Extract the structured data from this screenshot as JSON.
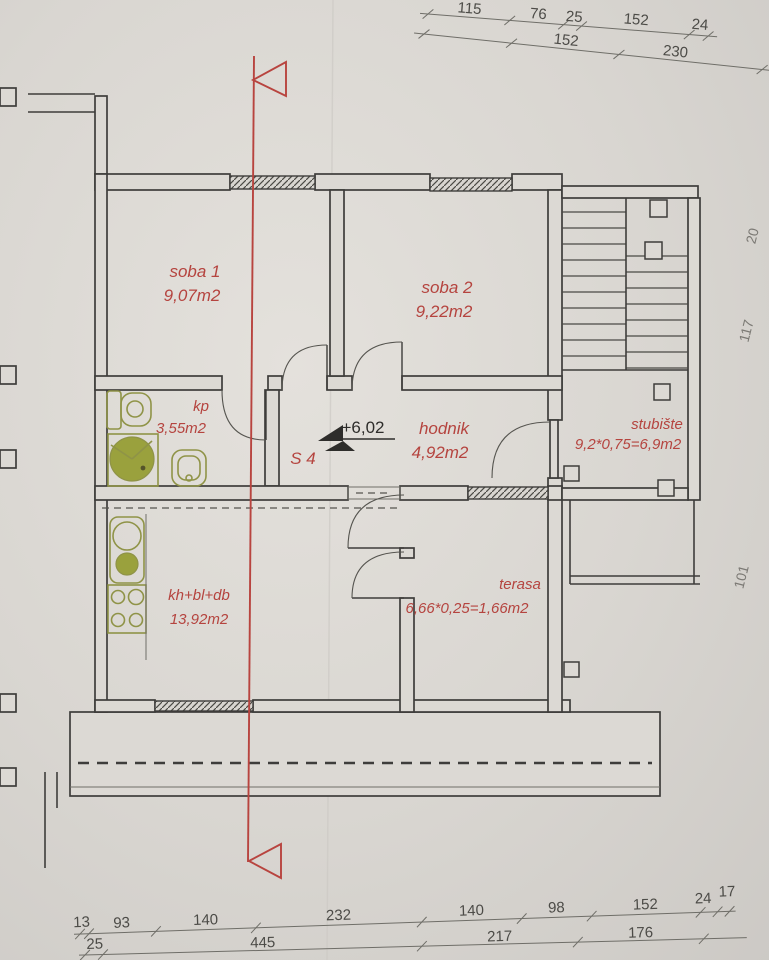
{
  "plan": {
    "rooms": [
      {
        "id": "soba1",
        "name": "soba 1",
        "area": "9,07m2"
      },
      {
        "id": "soba2",
        "name": "soba 2",
        "area": "9,22m2"
      },
      {
        "id": "kp",
        "name": "kp",
        "area": "3,55m2"
      },
      {
        "id": "hodnik",
        "name": "hodnik",
        "area": "4,92m2"
      },
      {
        "id": "stubiste",
        "name": "stubište",
        "area": "9,2*0,75=6,9m2"
      },
      {
        "id": "kuhinja",
        "name": "kh+bl+db",
        "area": "13,92m2"
      },
      {
        "id": "terasa",
        "name": "terasa",
        "area": "6,66*0,25=1,66m2"
      }
    ],
    "section_mark": {
      "label": "S 4",
      "elevation": "+6,02"
    },
    "dims_top_row1": [
      "115",
      "76",
      "25",
      "152",
      "24"
    ],
    "dims_top_row2": [
      "152",
      "230"
    ],
    "dims_bottom_row1": [
      "13",
      "93",
      "140",
      "232",
      "140",
      "98",
      "152",
      "24",
      "17"
    ],
    "dims_bottom_row2": [
      "25",
      "445",
      "217",
      "176"
    ],
    "dims_right": [
      "20",
      "117",
      "101"
    ],
    "colors": {
      "label_red": "#b5443f",
      "section_red": "#b8443f",
      "fixture_olive": "#8f9347",
      "line_dark": "#3e3d3b"
    }
  }
}
